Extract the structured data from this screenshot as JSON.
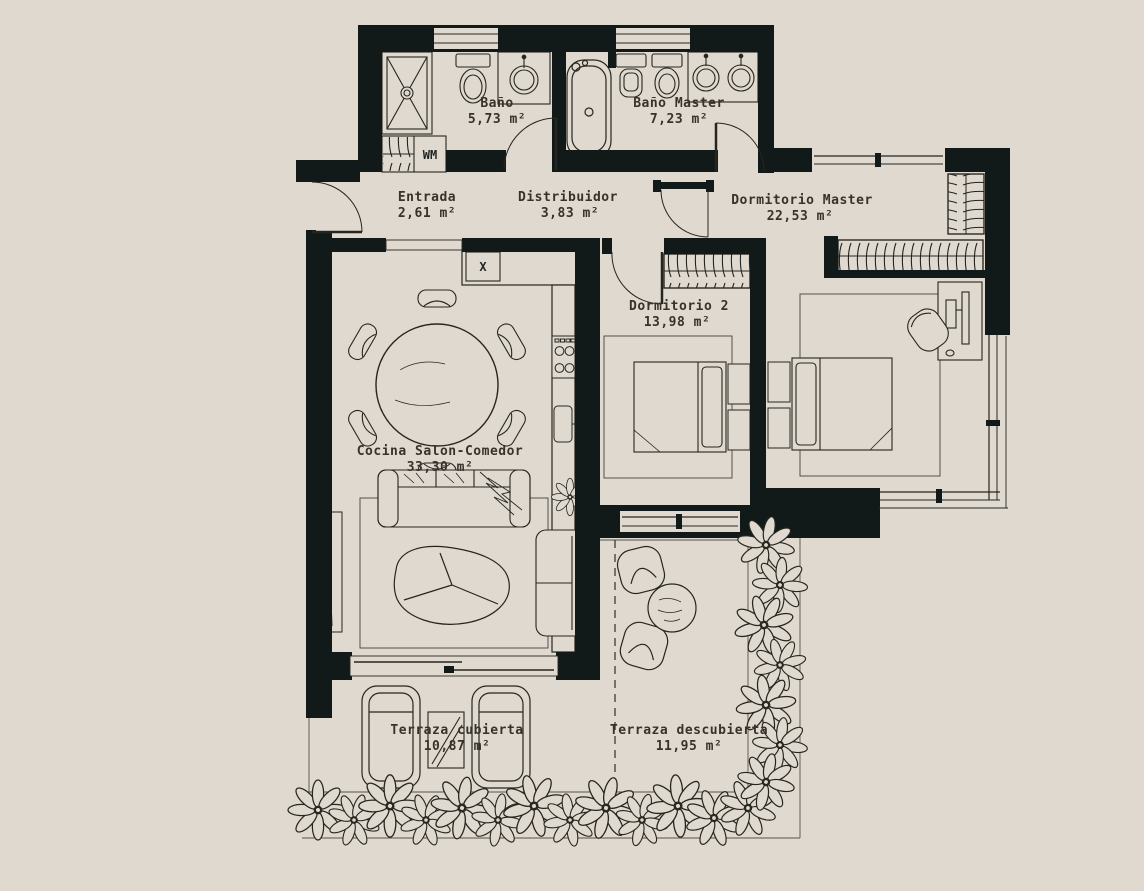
{
  "plan_title": "Apartment floor plan",
  "rooms": [
    {
      "label": "Baño",
      "area": "5,73 m²"
    },
    {
      "label": "Baño Master",
      "area": "7,23 m²"
    },
    {
      "label": "Entrada",
      "area": "2,61 m²"
    },
    {
      "label": "Distribuidor",
      "area": "3,83 m²"
    },
    {
      "label": "Dormitorio Master",
      "area": "22,53 m²"
    },
    {
      "label": "Dormitorio 2",
      "area": "13,98 m²"
    },
    {
      "label": "Cocina Salon-Comedor",
      "area": "33,30 m²"
    },
    {
      "label": "Terraza cubierta",
      "area": "10,87 m²"
    },
    {
      "label": "Terraza descubierta",
      "area": "11,95 m²"
    }
  ],
  "markers": {
    "washing_machine": "WM",
    "kitchen_unit_mark": "X"
  },
  "colors": {
    "background": "#DFD9D0",
    "wall": "#121A19",
    "line": "#26261F",
    "label": "#3A322A"
  }
}
